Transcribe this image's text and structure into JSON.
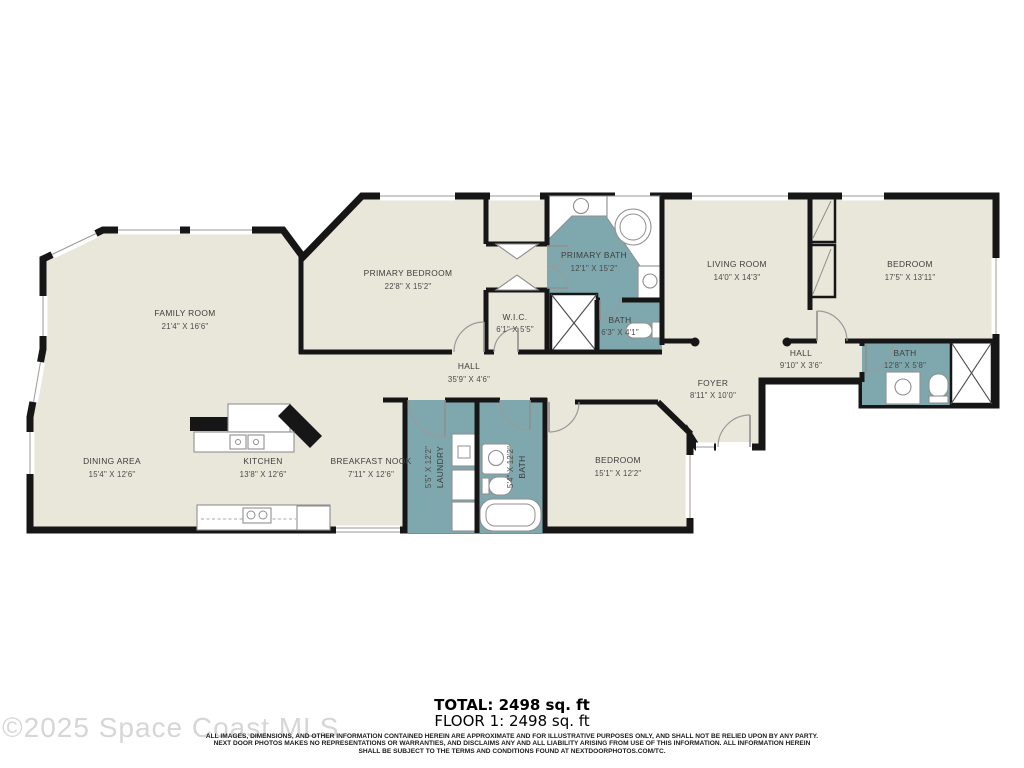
{
  "colors": {
    "floor": "#e9e6da",
    "wet": "#7ea8ae",
    "wall": "#161616",
    "watermark": "#d6d6d6"
  },
  "rooms": [
    {
      "id": "family-room",
      "name": "FAMILY ROOM",
      "dims": "21'4\" X 16'6\""
    },
    {
      "id": "primary-bedroom",
      "name": "PRIMARY BEDROOM",
      "dims": "22'8\" X 15'2\""
    },
    {
      "id": "primary-bath",
      "name": "PRIMARY BATH",
      "dims": "12'1\" X 15'2\""
    },
    {
      "id": "wic",
      "name": "W.I.C.",
      "dims": "6'1\" X 5'5\""
    },
    {
      "id": "bath-primary-wc",
      "name": "BATH",
      "dims": "6'3\" X 4'1\""
    },
    {
      "id": "living-room",
      "name": "LIVING ROOM",
      "dims": "14'0\" X 14'3\""
    },
    {
      "id": "bedroom-upper",
      "name": "BEDROOM",
      "dims": "17'5\" X 13'11\""
    },
    {
      "id": "hall-main",
      "name": "HALL",
      "dims": "35'9\" X 4'6\""
    },
    {
      "id": "hall-right",
      "name": "HALL",
      "dims": "9'10\" X 3'6\""
    },
    {
      "id": "bath-right",
      "name": "BATH",
      "dims": "12'8\" X 5'8\""
    },
    {
      "id": "foyer",
      "name": "FOYER",
      "dims": "8'11\" X 10'0\""
    },
    {
      "id": "dining-area",
      "name": "DINING AREA",
      "dims": "15'4\" X 12'6\""
    },
    {
      "id": "kitchen",
      "name": "KITCHEN",
      "dims": "13'8\" X 12'6\""
    },
    {
      "id": "breakfast-nook",
      "name": "BREAKFAST NOOK",
      "dims": "7'11\" X 12'6\""
    },
    {
      "id": "laundry",
      "name": "LAUNDRY",
      "dims": "5'5\" X 12'2\""
    },
    {
      "id": "bath-lower",
      "name": "BATH",
      "dims": "5'4\" X 12'2\""
    },
    {
      "id": "bedroom-lower",
      "name": "BEDROOM",
      "dims": "15'1\" X 12'2\""
    }
  ],
  "footer": {
    "total": "TOTAL: 2498 sq. ft",
    "floor1": "FLOOR 1: 2498 sq. ft",
    "disclaimer1": "ALL IMAGES, DIMENSIONS, AND OTHER INFORMATION CONTAINED HEREIN ARE APPROXIMATE AND FOR ILLUSTRATIVE PURPOSES ONLY, AND SHALL NOT BE RELIED UPON BY ANY PARTY.",
    "disclaimer2": "NEXT DOOR PHOTOS MAKES NO REPRESENTATIONS OR WARRANTIES, AND DISCLAIMS ANY AND ALL LIABILITY ARISING FROM USE OF THIS INFORMATION. ALL INFORMATION HEREIN",
    "disclaimer3": "SHALL BE SUBJECT TO THE TERMS AND CONDITIONS FOUND AT NEXTDOORPHOTOS.COM/TC."
  },
  "watermark": "©2025 Space Coast MLS"
}
